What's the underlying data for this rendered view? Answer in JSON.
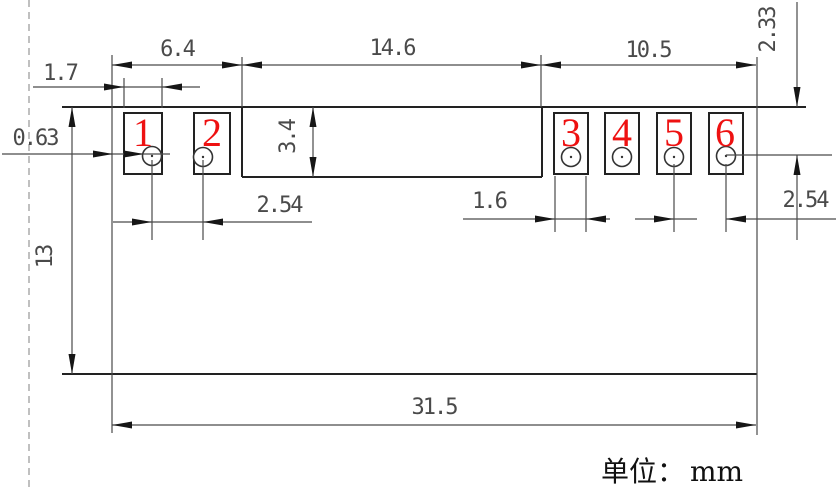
{
  "drawing": {
    "unit": {
      "prefix": "单位：",
      "value": "mm"
    },
    "dims": {
      "top_left_span": "6.4",
      "top_mid_span": "14.6",
      "top_right_span": "10.5",
      "pad_width_left": "1.7",
      "hole_leader": "0.63",
      "top_to_hole": "2.33",
      "body_height": "3.4",
      "pitch_left": "2.54",
      "pad_width_right": "1.6",
      "pitch_right": "2.54",
      "board_height": "13",
      "board_width": "31.5"
    },
    "pads": [
      {
        "label": "1"
      },
      {
        "label": "2"
      },
      {
        "label": "3"
      },
      {
        "label": "4"
      },
      {
        "label": "5"
      },
      {
        "label": "6"
      }
    ],
    "colors": {
      "outline": "#222222",
      "dimension": "#4a4a4a",
      "pad_number": "#ee1111",
      "dashed_guide": "#ababab",
      "background": "#ffffff"
    }
  }
}
